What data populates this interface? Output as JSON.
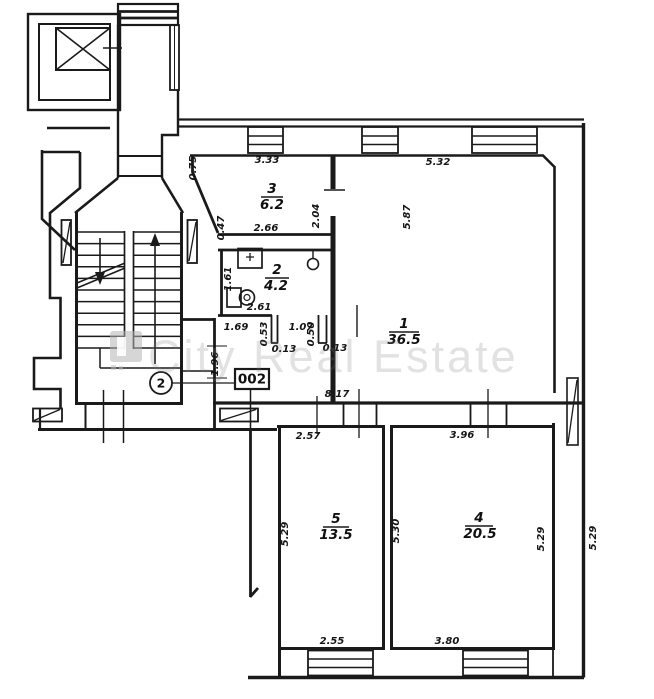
{
  "plan": {
    "watermark": "City Real Estate",
    "unit_label": "002",
    "stair_badge": "2",
    "rooms": [
      {
        "number": "1",
        "area": "36.5"
      },
      {
        "number": "2",
        "area": "4.2"
      },
      {
        "number": "3",
        "area": "6.2"
      },
      {
        "number": "4",
        "area": "20.5"
      },
      {
        "number": "5",
        "area": "13.5"
      }
    ],
    "dimensions": [
      {
        "v": "0.75"
      },
      {
        "v": "3.33"
      },
      {
        "v": "5.32"
      },
      {
        "v": "0.47"
      },
      {
        "v": "2.66"
      },
      {
        "v": "2.04"
      },
      {
        "v": "5.87"
      },
      {
        "v": "1.61"
      },
      {
        "v": "2.61"
      },
      {
        "v": "1.69"
      },
      {
        "v": "0.53"
      },
      {
        "v": "0.13"
      },
      {
        "v": "1.07"
      },
      {
        "v": "0.50"
      },
      {
        "v": "0.13"
      },
      {
        "v": "1.96"
      },
      {
        "v": "8.17"
      },
      {
        "v": "2.57"
      },
      {
        "v": "3.96"
      },
      {
        "v": "5.29"
      },
      {
        "v": "5.30"
      },
      {
        "v": "5.29"
      },
      {
        "v": "5.29"
      },
      {
        "v": "2.55"
      },
      {
        "v": "3.80"
      }
    ]
  }
}
